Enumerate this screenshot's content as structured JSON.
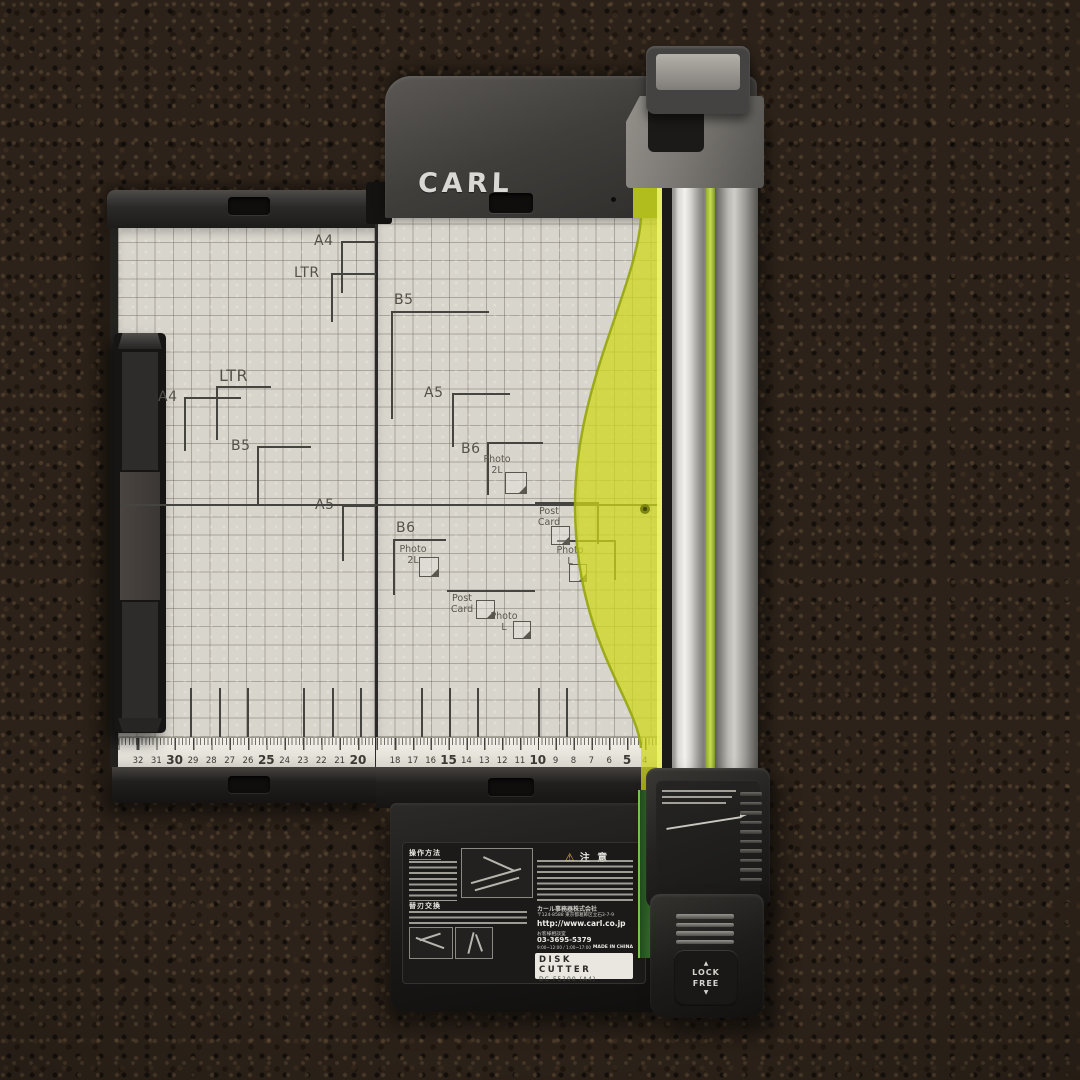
{
  "scene": {
    "subject": "CARL disk cutter rotary paper trimmer lying on dark brown carpet"
  },
  "branding": {
    "logo": "CARL"
  },
  "mat": {
    "size_marks": [
      {
        "label": "A4",
        "cx": 341,
        "cy": 241,
        "h": 35,
        "v": 52,
        "lx": 314,
        "ly": 233,
        "fs": 14
      },
      {
        "label": "LTR",
        "cx": 331,
        "cy": 273,
        "h": 45,
        "v": 49,
        "lx": 294,
        "ly": 265,
        "fs": 14
      },
      {
        "label": "LTR",
        "cx": 216,
        "cy": 386,
        "h": 55,
        "v": 54,
        "lx": 219,
        "ly": 366,
        "fs": 16
      },
      {
        "label": "A4",
        "cx": 184,
        "cy": 397,
        "h": 57,
        "v": 54,
        "lx": 158,
        "ly": 389,
        "fs": 14
      },
      {
        "label": "B5",
        "cx": 257,
        "cy": 446,
        "h": 54,
        "v": 58,
        "lx": 231,
        "ly": 438,
        "fs": 14
      },
      {
        "label": "A5",
        "cx": 342,
        "cy": 505,
        "h": 34,
        "v": 56,
        "lx": 315,
        "ly": 497,
        "fs": 14
      },
      {
        "label": "B5",
        "cx": 391,
        "cy": 311,
        "h": 98,
        "v": 108,
        "lx": 394,
        "ly": 292,
        "fs": 14
      },
      {
        "label": "A5",
        "cx": 452,
        "cy": 393,
        "h": 58,
        "v": 54,
        "lx": 424,
        "ly": 385,
        "fs": 14
      },
      {
        "label": "B6",
        "cx": 487,
        "cy": 442,
        "h": 56,
        "v": 53,
        "lx": 461,
        "ly": 441,
        "fs": 14
      },
      {
        "label": "B6",
        "cx": 393,
        "cy": 539,
        "h": 53,
        "v": 56,
        "lx": 396,
        "ly": 520,
        "fs": 14
      },
      {
        "label": "",
        "cx": 535,
        "cy": 502,
        "h": 62,
        "v": 42,
        "vr": true
      },
      {
        "label": "",
        "cx": 557,
        "cy": 540,
        "h": 57,
        "v": 40,
        "vr": true
      },
      {
        "label": "",
        "cx": 447,
        "cy": 590,
        "h": 88,
        "v": 0
      }
    ],
    "photo_marks": [
      {
        "l1": "Photo",
        "l2": "2L",
        "x": 497,
        "y": 455,
        "ix": 505,
        "iy": 472,
        "isz": 20
      },
      {
        "l1": "Photo",
        "l2": "2L",
        "x": 413,
        "y": 545,
        "ix": 419,
        "iy": 557,
        "isz": 18
      },
      {
        "l1": "Post",
        "l2": "Card",
        "x": 549,
        "y": 507,
        "ix": 551,
        "iy": 526,
        "isz": 17
      },
      {
        "l1": "Photo",
        "l2": "L",
        "x": 570,
        "y": 546,
        "ix": 569,
        "iy": 564,
        "isz": 16
      },
      {
        "l1": "Post",
        "l2": "Card",
        "x": 462,
        "y": 594,
        "ix": 476,
        "iy": 600,
        "isz": 17
      },
      {
        "l1": "Photo",
        "l2": "L",
        "x": 504,
        "y": 612,
        "ix": 513,
        "iy": 621,
        "isz": 16
      }
    ],
    "long_lines": [
      {
        "x": 120,
        "y": 504,
        "w": 540
      }
    ],
    "v_guides": [
      190,
      219,
      247,
      303,
      332,
      360,
      421,
      449,
      477,
      538,
      566
    ]
  },
  "ruler": {
    "left": [
      32,
      31,
      30,
      29,
      28,
      27,
      26,
      25,
      24,
      23,
      22,
      21,
      20
    ],
    "main": [
      18,
      17,
      16,
      15,
      14,
      13,
      12,
      11,
      10,
      9,
      8,
      7,
      6,
      5,
      4,
      3
    ]
  },
  "carriage": {
    "ridge_count": 10
  },
  "knob": {
    "up": "▲",
    "lock": "LOCK",
    "free": "FREE",
    "down": "▼"
  },
  "label": {
    "section1": "操作方法",
    "section2": "替刃交換",
    "caution_icon": "⚠",
    "caution": "注 意",
    "company": "カール事務器株式会社",
    "address": "〒124-8588 東京都葛飾区立石3-7-9",
    "url": "http://www.carl.co.jp",
    "support": "お客様相談室",
    "phone": "03-3695-5379",
    "hours": "9:00~12:00 / 1:00~17:00",
    "origin": "MADE IN CHINA",
    "product": "DISK CUTTER",
    "model": "DC-F5100 (A4)"
  },
  "colors": {
    "carpet": "#2c2219",
    "mat": "#d8d5cc",
    "housing": "#3a3835",
    "yellow_guide": "#cbd519",
    "rail_silver": "#d9d8d3",
    "green_strip": "#cde055",
    "caution_yellow": "#e9c21c"
  }
}
